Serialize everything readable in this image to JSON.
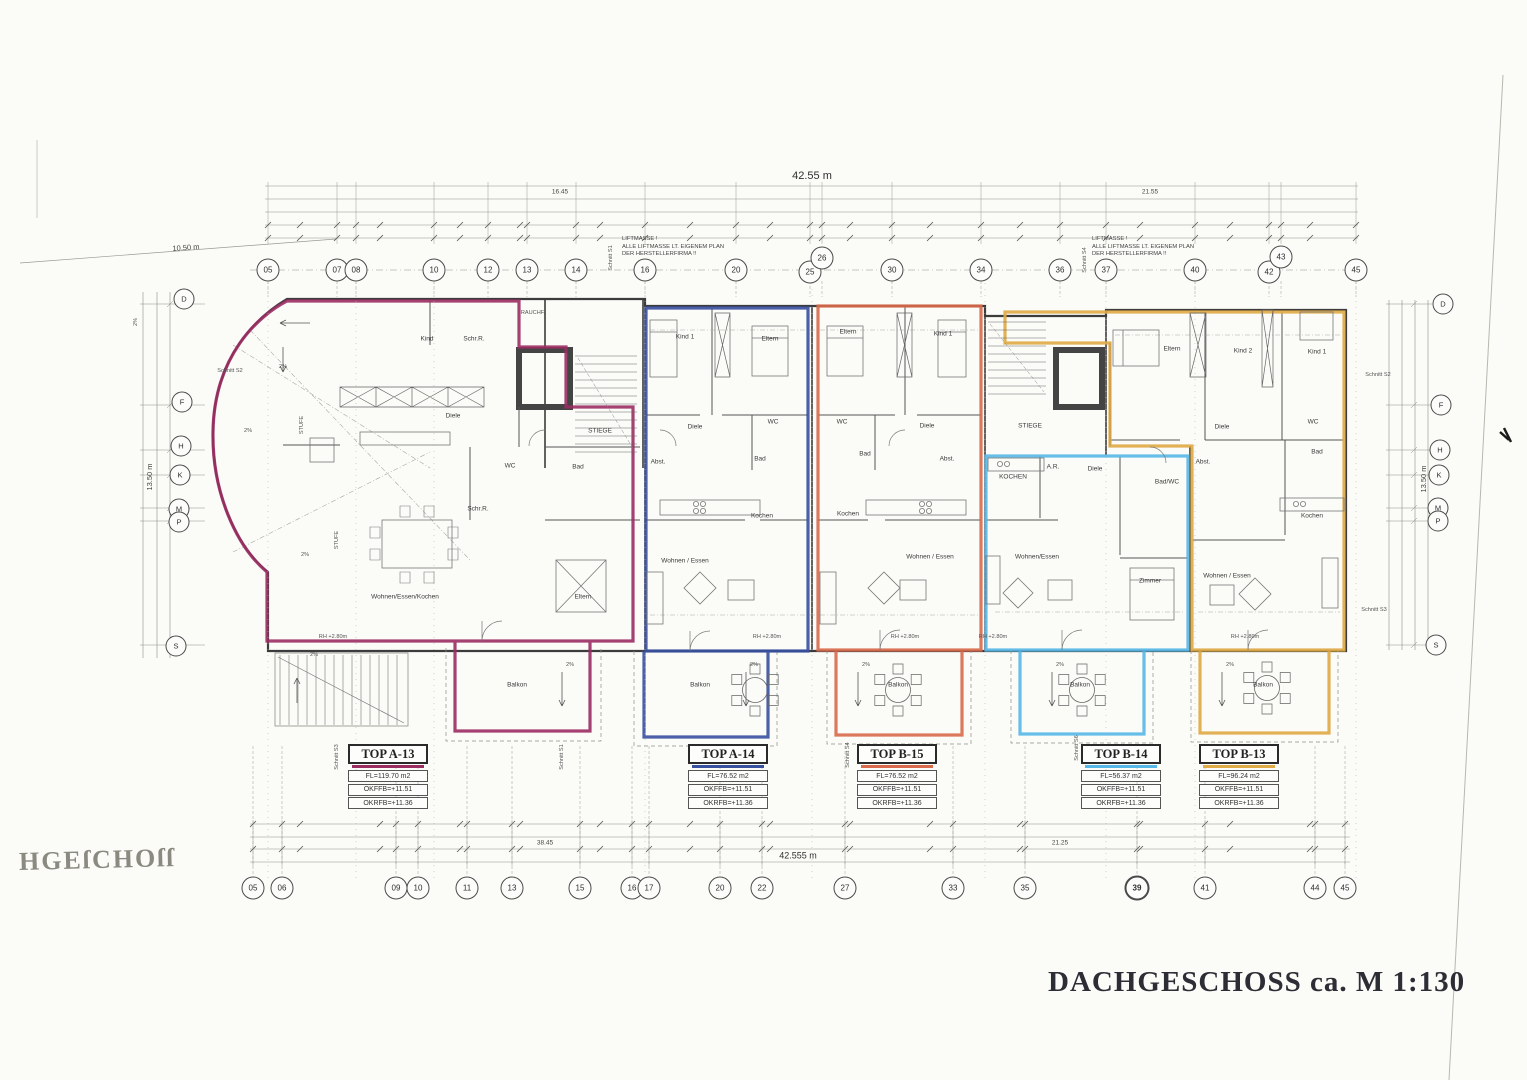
{
  "page": {
    "title": "DACHGESCHOSS ca. M 1:130",
    "corner": "HGEſCHOſſ"
  },
  "liftnote": {
    "l1": "LIFTMASSE !",
    "l2": "ALLE LIFTMASSE LT. EIGENEM PLAN",
    "l3": "DER HERSTELLERFIRMA !!"
  },
  "dims": {
    "top_total": "42.55 m",
    "top_left": "16.45",
    "top_right": "21.55",
    "bottom_total": "42.555 m",
    "bottom_left": "38.45",
    "bottom_right": "21.25",
    "left_width": "10.50 m",
    "left_height": "13.50 m",
    "right_height": "13.50 m"
  },
  "grid_top": [
    "05",
    "07",
    "08",
    "10",
    "12",
    "13",
    "14",
    "16",
    "20",
    "25",
    "26",
    "30",
    "34",
    "36",
    "37",
    "40",
    "42",
    "43",
    "45"
  ],
  "grid_bottom": [
    "05",
    "06",
    "09",
    "10",
    "11",
    "13",
    "15",
    "16",
    "17",
    "20",
    "22",
    "27",
    "33",
    "35",
    "39",
    "41",
    "44",
    "45"
  ],
  "letters": [
    "D",
    "F",
    "H",
    "K",
    "M",
    "P",
    "S"
  ],
  "units": [
    {
      "title": "TOP A-13",
      "color": "#9b2d63",
      "fl": "FL=119.70 m2",
      "okffb": "OKFFB=+11.51",
      "okrfb": "OKRFB=+11.36",
      "rooms": {
        "r1": "Kind",
        "r2": "Schr.R.",
        "r3": "Diele",
        "r4": "Schr.R.",
        "r5": "WC",
        "r6": "Bad",
        "r7": "Wohnen/Essen/Kochen",
        "r8": "Eltern",
        "balkon": "Balkon"
      }
    },
    {
      "title": "TOP A-14",
      "color": "#3850a0",
      "fl": "FL=76.52 m2",
      "okffb": "OKFFB=+11.51",
      "okrfb": "OKRFB=+11.36",
      "rooms": {
        "r1": "Kind 1",
        "r2": "Eltern",
        "r3": "Diele",
        "r4": "WC",
        "r5": "Bad",
        "r6": "Abst.",
        "r7": "Kochen",
        "r8": "Wohnen / Essen",
        "balkon": "Balkon"
      }
    },
    {
      "title": "TOP B-15",
      "color": "#d96a4b",
      "fl": "FL=76.52 m2",
      "okffb": "OKFFB=+11.51",
      "okrfb": "OKRFB=+11.36",
      "rooms": {
        "r1": "Eltern",
        "r2": "Kind 1",
        "r3": "WC",
        "r4": "Diele",
        "r5": "Bad",
        "r6": "Abst.",
        "r7": "Kochen",
        "r8": "Wohnen / Essen",
        "balkon": "Balkon"
      }
    },
    {
      "title": "TOP B-14",
      "color": "#57b8e8",
      "fl": "FL=56.37 m2",
      "okffb": "OKFFB=+11.51",
      "okrfb": "OKRFB=+11.36",
      "rooms": {
        "r1": "KOCHEN",
        "r2": "A.R.",
        "r3": "Diele",
        "r4": "Bad/WC",
        "r5": "Wohnen/Essen",
        "r6": "Zimmer",
        "balkon": "Balkon"
      }
    },
    {
      "title": "TOP B-13",
      "color": "#e0aa45",
      "fl": "FL=96.24 m2",
      "okffb": "OKFFB=+11.51",
      "okrfb": "OKRFB=+11.36",
      "rooms": {
        "r1": "Eltern",
        "r2": "Kind 2",
        "r3": "Kind 1",
        "r4": "Diele",
        "r5": "WC",
        "r6": "Bad",
        "r7": "Abst.",
        "r8": "Kochen",
        "r9": "Wohnen / Essen",
        "balkon": "Balkon"
      }
    }
  ],
  "misc": {
    "stiege": "STIEGE",
    "stufe": "STUFE",
    "rauchfang": "RAUCHF.",
    "slope": "2%",
    "rh": "RH +2.80m"
  },
  "schnitt": {
    "s1": "Schnitt S1",
    "s2": "Schnitt S2",
    "s3": "Schnitt S3",
    "s4": "Schnitt S4",
    "s6": "Schnitt S6"
  }
}
